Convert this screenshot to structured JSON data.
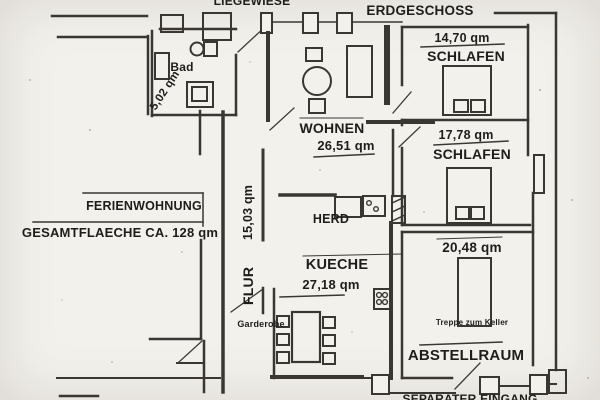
{
  "header": {
    "liegewiese": "LIEGEWIESE",
    "erdgeschoss": "ERDGESCHOSS"
  },
  "apartment": {
    "name": "FERIENWOHNUNG",
    "total_area": "GESAMTFLAECHE CA. 128 qm"
  },
  "rooms": {
    "bad": {
      "name": "Bad",
      "area": "5,02 qm"
    },
    "wohnen": {
      "name": "WOHNEN",
      "area": "26,51 qm"
    },
    "schlafen_1": {
      "name": "SCHLAFEN",
      "area": "14,70 qm"
    },
    "schlafen_2": {
      "name": "SCHLAFEN",
      "area": "17,78 qm"
    },
    "flur": {
      "name": "FLUR",
      "area": "15,03 qm"
    },
    "kueche": {
      "name": "KUECHE",
      "area": "27,18 qm",
      "stove": "HERD"
    },
    "abstellraum": {
      "name": "ABSTELLRAUM",
      "area": "20,48 qm",
      "stairs_note": "Treppe zum Keller"
    },
    "garderobe": {
      "name": "Garderobe"
    }
  },
  "entrance": {
    "label": "SEPARATER EINGANG"
  },
  "colors": {
    "paper": "#f3f1ec",
    "ink": "#3a3733",
    "text": "#1f1d1a"
  }
}
